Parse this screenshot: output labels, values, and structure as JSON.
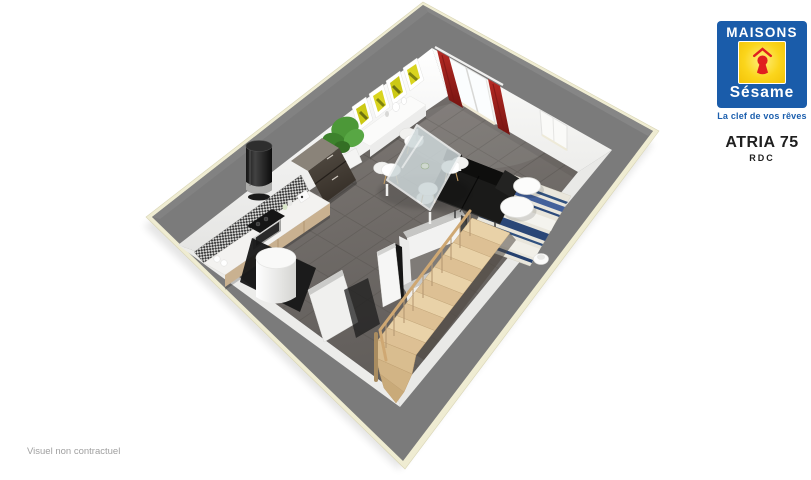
{
  "header": {
    "brand_top": "MAISONS",
    "brand_script": "Sésame",
    "tagline": "La clef de vos rêves",
    "model": "ATRIA 75",
    "level": "RDC"
  },
  "footer": {
    "disclaimer": "Visuel non contractuel"
  },
  "palette": {
    "brand_blue": "#1a5caa",
    "brand_yellow": "#fbd51c",
    "brand_red": "#e01f1f",
    "wall_gray": "#7b7b7b",
    "slab_cream": "#efecd2",
    "floor_dark_tile": "#6b6764",
    "interior_wall_white": "#f6f6f5",
    "curtain_red": "#a32420",
    "stair_wood": "#e2c89e",
    "rug_navy": "#2c4a7c",
    "rug_cream": "#e9e6dc",
    "plant_green": "#4c9838",
    "sofa_black": "#1a1a19",
    "counter_wood": "#c9b190"
  },
  "floorplan": {
    "view": "3d-aerial-floorplan",
    "elements": [
      "gray perimeter walls",
      "dark tiled floor",
      "red curtains with sliding bay window",
      "small window",
      "wall art frames",
      "white sideboard with vases",
      "green plant",
      "fridge",
      "black column stove hood",
      "kitchen counter with cooktop and oven",
      "mosaic backsplash",
      "water heater cylinder",
      "storage cupboard",
      "wc partition walls",
      "glass dining table",
      "four white chairs",
      "black sofa",
      "striped blue rug",
      "two round coffee tables",
      "floor vase",
      "wooden staircase with railing"
    ]
  }
}
